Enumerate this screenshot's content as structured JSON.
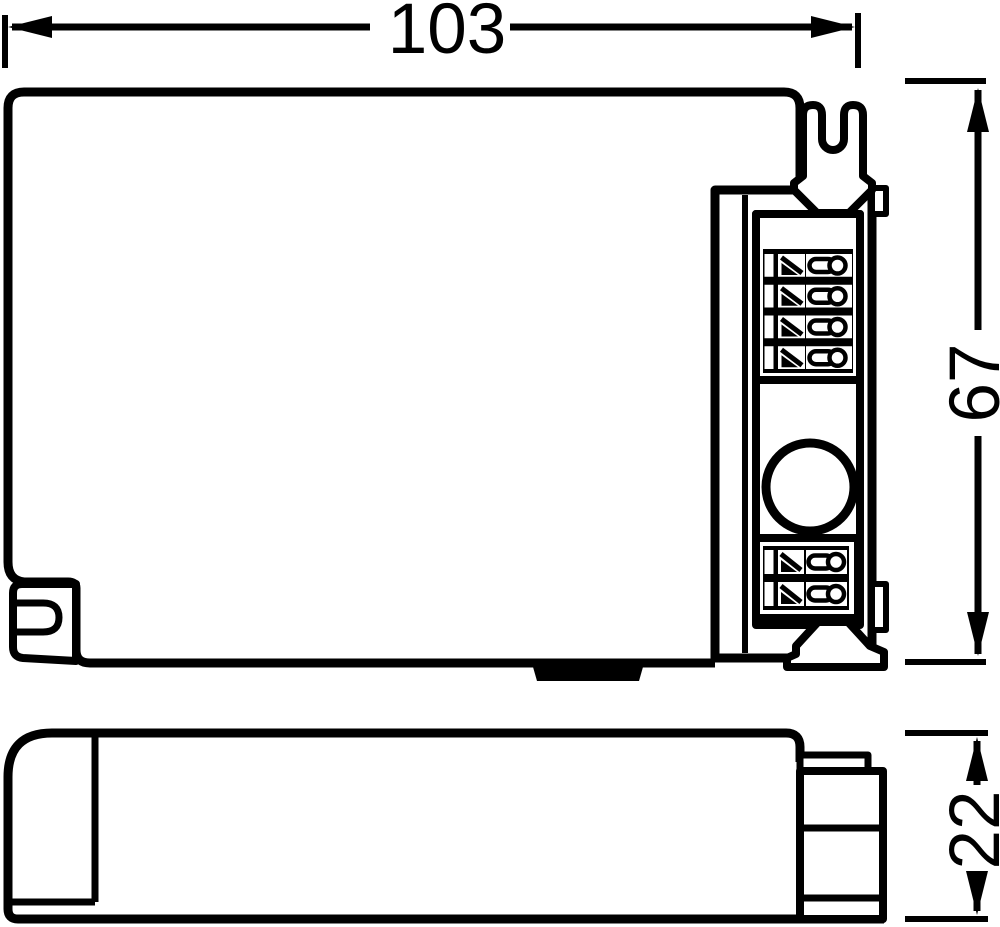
{
  "drawing": {
    "type": "technical-dimension-drawing",
    "subject": "electronic control gear (ballast) housing outline, top view and side view",
    "colors": {
      "line": "#000000",
      "background": "#ffffff"
    }
  },
  "dimensions": {
    "width": {
      "value": "103"
    },
    "height": {
      "value": "67"
    },
    "depth": {
      "value": "22"
    }
  },
  "top_view": {
    "terminal_block_top": {
      "poles": 4
    },
    "terminal_block_bottom": {
      "poles": 2
    },
    "features": [
      "mounting-slot-top-right",
      "mounting-slot-bottom-left",
      "circular-knockout",
      "snap-tab-bottom-edge",
      "terminal-channel-right"
    ]
  },
  "side_view": {
    "features": [
      "end-cap-seam-left",
      "terminal-block-profile-right"
    ]
  }
}
